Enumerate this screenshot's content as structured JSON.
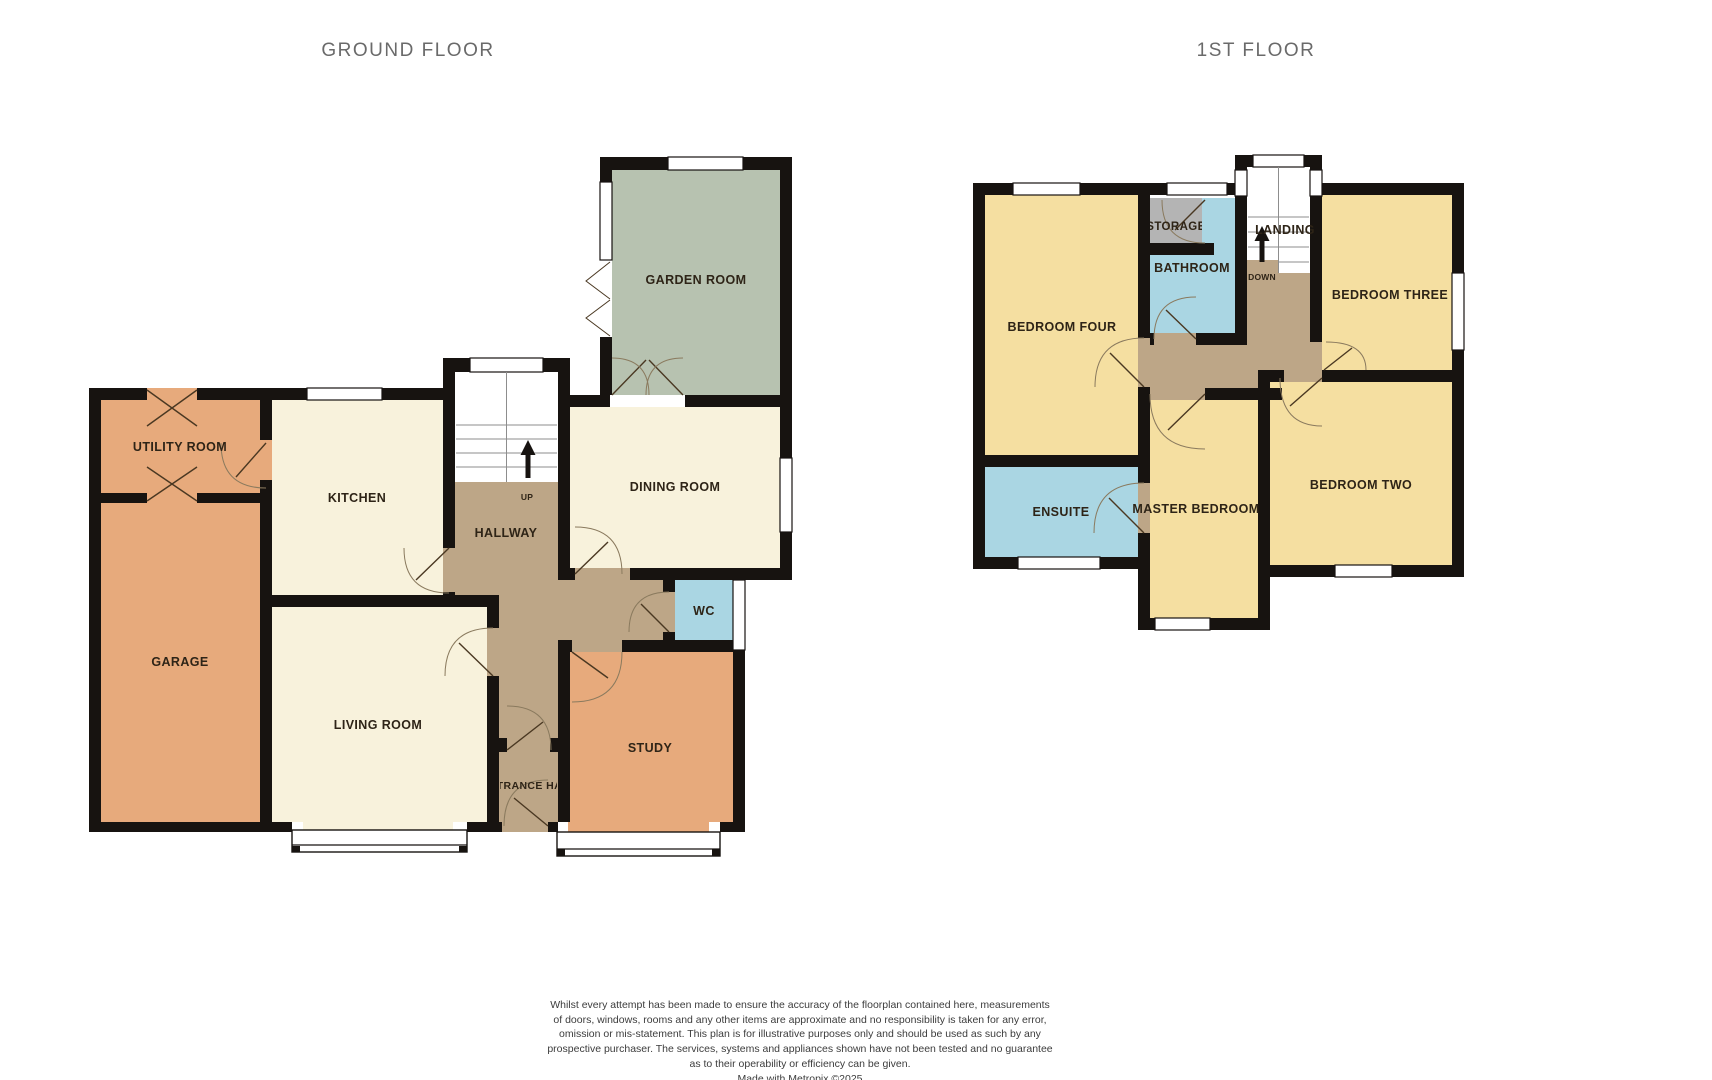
{
  "colors": {
    "wall": "#171310",
    "cream": "#f8f2dc",
    "orange": "#e7aa7c",
    "sage": "#b7c2b0",
    "corridor_brown": "#bda687",
    "wet_room_blue": "#aad6e3",
    "bedroom_yellow": "#f5dfa1",
    "storage_gray": "#b4b4b4",
    "title_gray": "#6a6a6a"
  },
  "ground": {
    "title": "GROUND FLOOR",
    "rooms": {
      "garden": "GARDEN ROOM",
      "dining": "DINING ROOM",
      "kitchen": "KITCHEN",
      "utility": "UTILITY ROOM",
      "garage": "GARAGE",
      "living": "LIVING ROOM",
      "hallway": "HALLWAY",
      "entrance": "ENTRANCE HALL",
      "wc": "WC",
      "study": "STUDY"
    },
    "stairs_label": "UP"
  },
  "first": {
    "title": "1ST FLOOR",
    "rooms": {
      "bedroom4": "BEDROOM FOUR",
      "bedroom3": "BEDROOM THREE",
      "bedroom2": "BEDROOM TWO",
      "master": "MASTER BEDROOM",
      "ensuite": "ENSUITE",
      "bathroom": "BATHROOM",
      "storage": "STORAGE",
      "landing": "LANDING"
    },
    "stairs_label": "DOWN"
  },
  "footer": {
    "lines": [
      "Whilst every attempt has been made to ensure the accuracy of the floorplan contained here, measurements",
      "of doors, windows, rooms and any other items are approximate and no responsibility is taken for any error,",
      "omission or mis-statement. This plan is for illustrative purposes only and should be used as such by any",
      "prospective purchaser. The services, systems and appliances shown have not been tested and no guarantee",
      "as to their operability or efficiency can be given."
    ],
    "credit": "Made with Metropix ©2025"
  }
}
